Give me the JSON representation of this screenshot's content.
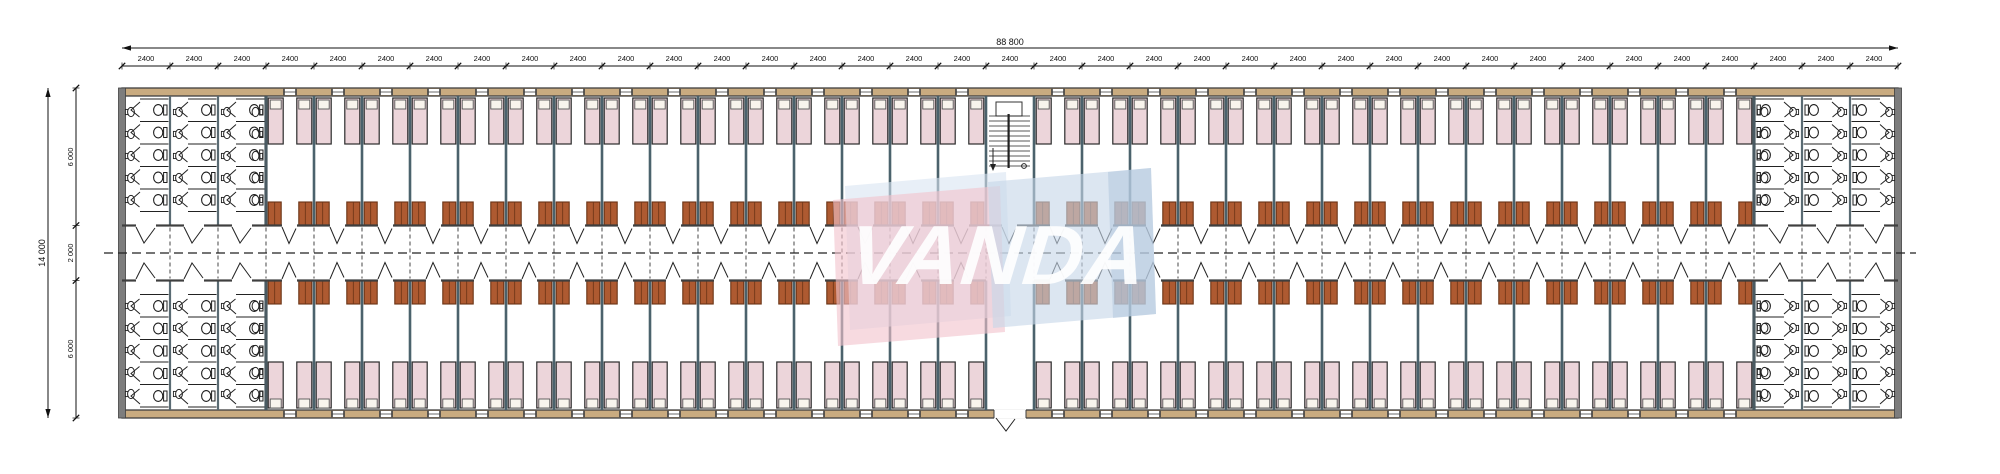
{
  "watermark": {
    "text": "VANDA",
    "pink": "#f2c3cd",
    "back_blue": "#d8e5f2",
    "blue": "#c6d7e9",
    "blue_accent": "#aec4dc",
    "text_color": "#ffffff"
  },
  "dimensions": {
    "top": {
      "overall_label": "88 800",
      "bay_label": "2400",
      "bay_count": 37
    },
    "left": {
      "overall_label": "14 000",
      "top_label": "6 000",
      "middle_label": "2 000",
      "bottom_label": "6 000"
    }
  },
  "layout": {
    "bath_bays_each_end": 3,
    "room_bays_per_wing": 15,
    "stair_bay_index_zero_based": 18,
    "beds_per_room": 2
  },
  "colors": {
    "wall": "#3f3f3f",
    "end_wall": "#7d7d7d",
    "band_tan": "#c9ab80",
    "partition": "#4b626c",
    "bath_wall": "#5a6b73",
    "block_wall": "#4a5a62",
    "bed_fill": "#ecd5da",
    "bed_stroke": "#2b2b2b",
    "pillow_fill": "#f8f4ed",
    "wardrobe_fill": "#ae5a31",
    "wardrobe_stroke": "#6a3315",
    "fixture": "#1f1f1f",
    "dim_line": "#111111",
    "dash": "#333333",
    "background": "#ffffff"
  }
}
